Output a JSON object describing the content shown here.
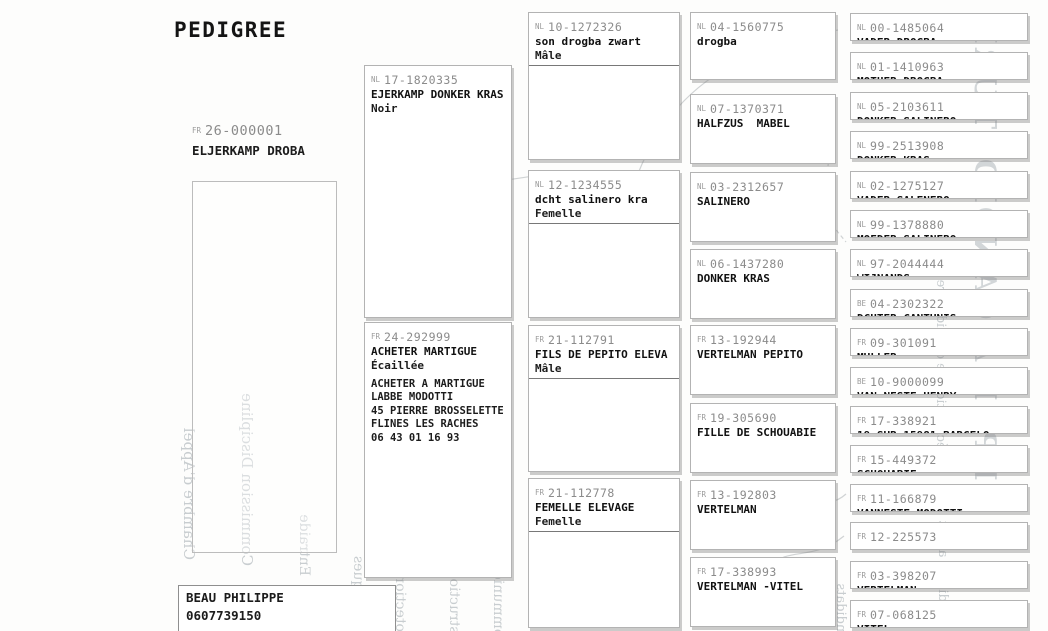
{
  "title": "PEDIGREE",
  "subject": {
    "country": "FR",
    "ring": "26-000001",
    "name": "ELJERKAMP DROBA"
  },
  "breeder": {
    "name": "BEAU PHILIPPE",
    "phone": "0607739150"
  },
  "generations": {
    "gen1": [
      {
        "country": "NL",
        "ring": "17-1820335",
        "name": "EJERKAMP DONKER KRAS",
        "color": "Noir",
        "sex": "",
        "notes": []
      },
      {
        "country": "FR",
        "ring": "24-292999",
        "name": "ACHETER MARTIGUE",
        "color": "Écaillée",
        "sex": "",
        "notes": [
          "ACHETER A MARTIGUE",
          "LABBE MODOTTI",
          "45 PIERRE BROSSELETTE",
          "FLINES LES RACHES",
          "06 43 01 16 93"
        ]
      }
    ],
    "gen2": [
      {
        "country": "NL",
        "ring": "10-1272326",
        "name": "son drogba zwart",
        "color": "",
        "sex": "Mâle",
        "notes": []
      },
      {
        "country": "NL",
        "ring": "12-1234555",
        "name": "dcht salinero kra",
        "color": "",
        "sex": "Femelle",
        "notes": []
      },
      {
        "country": "FR",
        "ring": "21-112791",
        "name": "FILS DE PEPITO ELEVA",
        "color": "",
        "sex": "Mâle",
        "notes": []
      },
      {
        "country": "FR",
        "ring": "21-112778",
        "name": "FEMELLE ELEVAGE",
        "color": "",
        "sex": "Femelle",
        "notes": []
      }
    ],
    "gen3": [
      {
        "country": "NL",
        "ring": "04-1560775",
        "name": "drogba"
      },
      {
        "country": "NL",
        "ring": "07-1370371",
        "name": "HALFZUS  MABEL"
      },
      {
        "country": "NL",
        "ring": "03-2312657",
        "name": "SALINERO"
      },
      {
        "country": "NL",
        "ring": "06-1437280",
        "name": "DONKER KRAS"
      },
      {
        "country": "FR",
        "ring": "13-192944",
        "name": "VERTELMAN PEPITO"
      },
      {
        "country": "FR",
        "ring": "19-305690",
        "name": "FILLE DE SCHOUABIE"
      },
      {
        "country": "FR",
        "ring": "13-192803",
        "name": "VERTELMAN"
      },
      {
        "country": "FR",
        "ring": "17-338993",
        "name": "VERTELMAN -VITEL"
      }
    ],
    "gen4": [
      {
        "country": "NL",
        "ring": "00-1485064",
        "name": "VADER DROGBA"
      },
      {
        "country": "NL",
        "ring": "01-1410963",
        "name": "MOTHER DROGBA"
      },
      {
        "country": "NL",
        "ring": "05-2103611",
        "name": "DONKER SALINERO"
      },
      {
        "country": "NL",
        "ring": "99-2513908",
        "name": "DONKER KRAS"
      },
      {
        "country": "NL",
        "ring": "02-1275127",
        "name": "VADER SALENERO"
      },
      {
        "country": "NL",
        "ring": "99-1378880",
        "name": "MOEDER SALINERO"
      },
      {
        "country": "NL",
        "ring": "97-2044444",
        "name": "WIJNANDS"
      },
      {
        "country": "BE",
        "ring": "04-2302322",
        "name": "DCHTER CANTUNIS"
      },
      {
        "country": "FR",
        "ring": "09-301091",
        "name": "MULLER"
      },
      {
        "country": "BE",
        "ring": "10-9000099",
        "name": "VAN NESTE HENRY"
      },
      {
        "country": "FR",
        "ring": "17-338921",
        "name": "19 SUR 15981 BARCELO"
      },
      {
        "country": "FR",
        "ring": "15-449372",
        "name": "SCHOUABIE"
      },
      {
        "country": "FR",
        "ring": "11-166879",
        "name": "VANNESTE MODOTTI"
      },
      {
        "country": "FR",
        "ring": "12-225573",
        "name": ""
      },
      {
        "country": "FR",
        "ring": "03-398207",
        "name": "VERTELMAN"
      },
      {
        "country": "FR",
        "ring": "07-068125",
        "name": "VITEL"
      }
    ]
  },
  "watermarks": [
    "Chambre d'Appel",
    "Commission Discipline",
    "Entraide",
    "Scientifiques",
    "Protection et Con",
    "Instruction",
    "Communication",
    "Contrôle",
    "Sportive",
    "Trésorier",
    "Candidats",
    "Candidats avant",
    "déclaration de candidature",
    "APPEL A CANDIDATURE"
  ]
}
